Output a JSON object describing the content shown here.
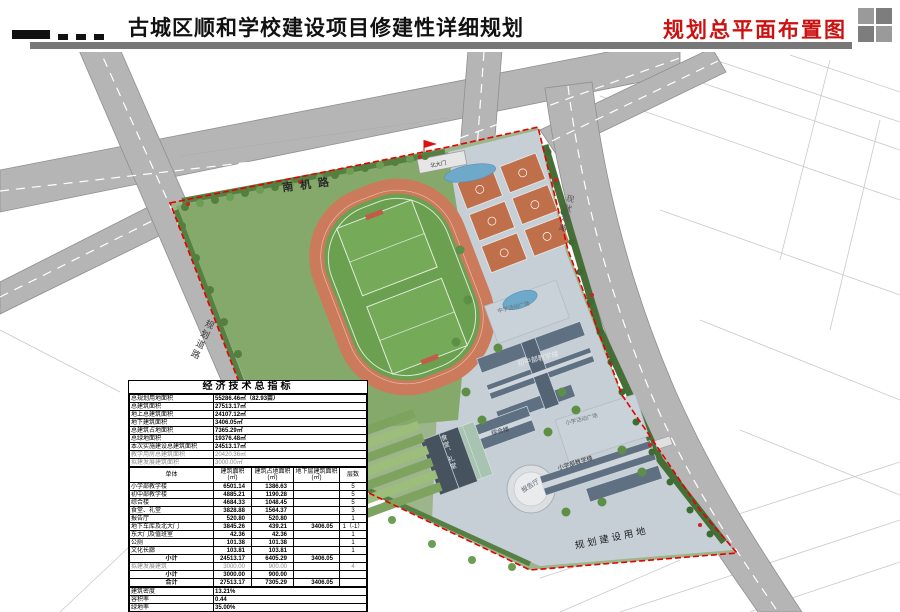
{
  "header": {
    "title": "古城区顺和学校建设项目修建性详细规划",
    "subtitle": "规划总平面布置图"
  },
  "colors": {
    "accent_red": "#cc1111",
    "boundary_red": "#e60000",
    "road_gray": "#b5b5b5",
    "track_ring": "#cb7a5b",
    "field_green": "#6aa050",
    "court_orange": "#bf6f4a",
    "roof_gray": "#5f7082",
    "plaza_gray": "#c9d2d8",
    "water_blue": "#6fa9c9"
  },
  "map": {
    "labels": {
      "road_nanji": "南机路",
      "road_planned": "规划道路",
      "road_existing": "现状道路",
      "land_planned": "规划建设用地",
      "north_gate": "北大门",
      "ms_plaza": "中学活动广场",
      "ms_building": "初中部教学楼",
      "ps_plaza": "小学活动广场",
      "ps_building": "小学部教学楼",
      "lecture_hall": "报告厅",
      "complex_building": "综合楼",
      "canteen": "食堂、礼堂"
    }
  },
  "table": {
    "title": "经济技术总指标",
    "indicators": [
      {
        "label": "总规划用地面积",
        "value": "55286.46㎡（82.93亩）"
      },
      {
        "label": "总建筑面积",
        "value": "27513.17㎡"
      },
      {
        "label": "地上总建筑面积",
        "value": "24107.12㎡"
      },
      {
        "label": "地下建筑面积",
        "value": "3406.05㎡"
      },
      {
        "label": "总建筑占地面积",
        "value": "7365.29㎡"
      },
      {
        "label": "总绿地面积",
        "value": "19376.48㎡"
      },
      {
        "label": "本次实施建设总建筑面积",
        "value": "24513.17㎡"
      },
      {
        "label": "教学用房总建筑面积",
        "value": "20420.36㎡",
        "cls": "gray"
      },
      {
        "label": "拟建发展建筑面积",
        "value": "3000.00㎡",
        "cls": "gray"
      }
    ],
    "columns": [
      "单体",
      "建筑面积 (㎡)",
      "建筑占地面积 (㎡)",
      "地下层建筑面积 (㎡)",
      "层数"
    ],
    "buildings": [
      {
        "name": "小学部教学楼",
        "area": "6501.14",
        "footprint": "1386.63",
        "underground": "",
        "floors": "5"
      },
      {
        "name": "初中部教学楼",
        "area": "4885.21",
        "footprint": "1190.28",
        "underground": "",
        "floors": "5"
      },
      {
        "name": "综合楼",
        "area": "4684.33",
        "footprint": "1048.45",
        "underground": "",
        "floors": "5"
      },
      {
        "name": "食堂、礼堂",
        "area": "3828.88",
        "footprint": "1564.37",
        "underground": "",
        "floors": "3"
      },
      {
        "name": "报告厅",
        "area": "520.80",
        "footprint": "520.80",
        "underground": "",
        "floors": "1"
      },
      {
        "name": "地下车库及北大门",
        "area": "3845.26",
        "footprint": "439.21",
        "underground": "3406.05",
        "floors": "1（-1）"
      },
      {
        "name": "东大门及值班室",
        "area": "42.36",
        "footprint": "42.36",
        "underground": "",
        "floors": "1"
      },
      {
        "name": "公厕",
        "area": "101.38",
        "footprint": "101.38",
        "underground": "",
        "floors": "1"
      },
      {
        "name": "文化长廊",
        "area": "103.81",
        "footprint": "103.81",
        "underground": "",
        "floors": "1"
      },
      {
        "name": "小计",
        "area": "24513.17",
        "footprint": "6405.29",
        "underground": "3406.05",
        "floors": "",
        "cls": "sum"
      },
      {
        "name": "拟建发展建筑",
        "area": "3000.00",
        "footprint": "900.00",
        "underground": "",
        "floors": "4",
        "cls": "gray"
      },
      {
        "name": "小计",
        "area": "3000.00",
        "footprint": "900.00",
        "underground": "",
        "floors": "",
        "cls": "sum"
      },
      {
        "name": "合计",
        "area": "27513.17",
        "footprint": "7305.29",
        "underground": "3406.05",
        "floors": "",
        "cls": "sum"
      }
    ],
    "footer": [
      {
        "label": "建筑密度",
        "value": "13.21%"
      },
      {
        "label": "容积率",
        "value": "0.44"
      },
      {
        "label": "绿地率",
        "value": "35.00%"
      },
      {
        "label": "停车位",
        "value": "173个（地下车库车位105个、地上绿地车位68个）"
      },
      {
        "label": "路边临时停靠式车位",
        "value": "50个"
      },
      {
        "label": "自行车位",
        "value": "172个（露天100个、室内72个）"
      }
    ]
  }
}
